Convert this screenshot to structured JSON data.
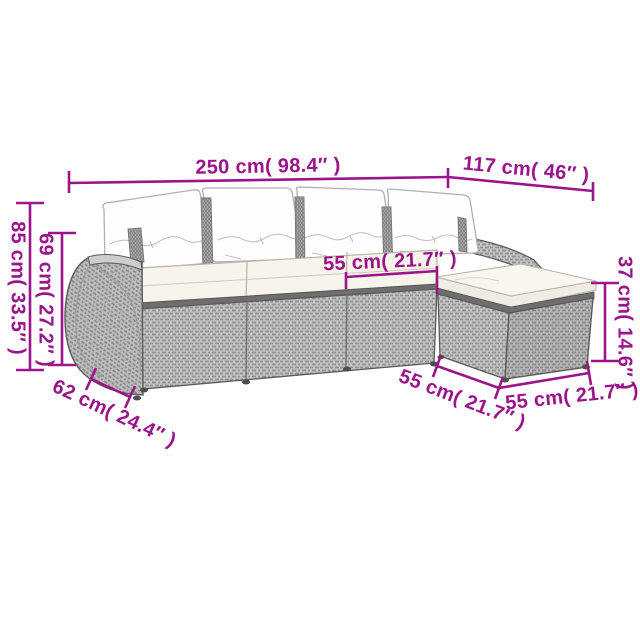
{
  "diagram": {
    "description": "5-piece rattan garden sofa set with cushions - dimension diagram",
    "labels": {
      "overall_width": "250 cm( 98.4″ )",
      "total_depth": "117 cm( 46″ )",
      "overall_height": "85 cm( 33.5″ )",
      "back_height": "69 cm( 27.2″ )",
      "seat_width": "55 cm( 21.7″ )",
      "ottoman_height": "37 cm( 14.6″ )",
      "arm_depth": "62 cm( 24.4″ )",
      "ottoman_width": "55 cm( 21.7″ )",
      "ottoman_depth": "55 cm( 21.7″ )"
    }
  },
  "colors": {
    "accent": "#9a148a",
    "background": "#ffffff",
    "outline": "#5a5a5a",
    "wicker-light": "#c6c6c6",
    "wicker-dark": "#8f8f8f",
    "cushion": "#f6f4eb",
    "pillow": "#fefefe",
    "rail": "#6e6e6e"
  }
}
